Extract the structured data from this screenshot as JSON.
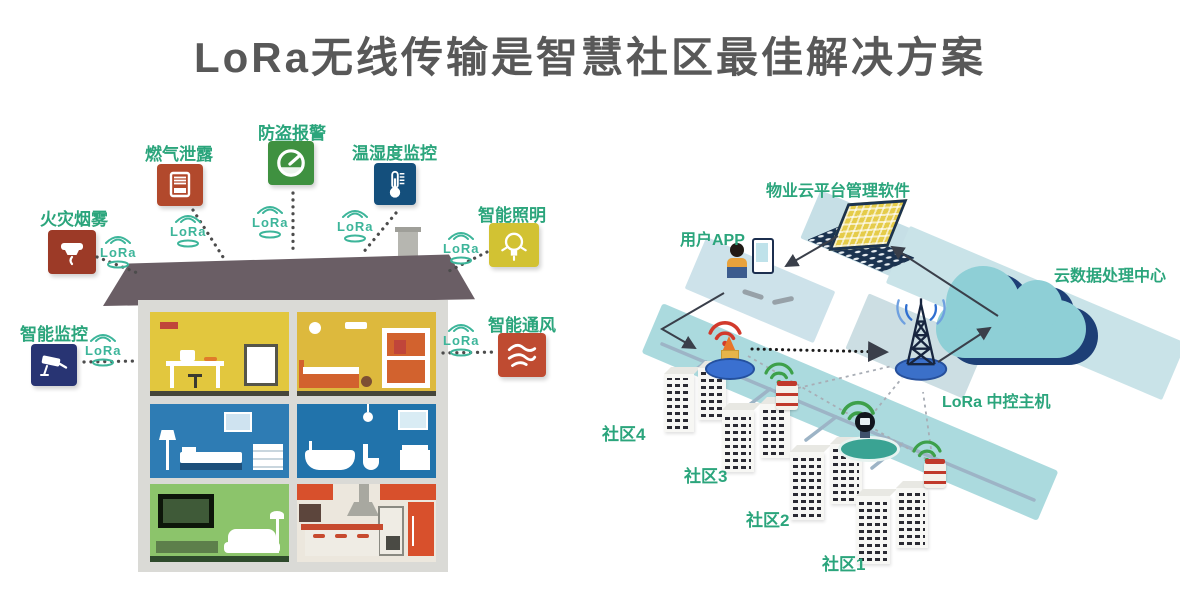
{
  "title": "LoRa无线传输是智慧社区最佳解决方案",
  "lora_badge": "LoRa",
  "sensors": [
    {
      "id": "fire-smoke",
      "label": "火灾烟雾",
      "color": "#9c3a27"
    },
    {
      "id": "gas-leak",
      "label": "燃气泄露",
      "color": "#b2492c"
    },
    {
      "id": "burglar-alarm",
      "label": "防盗报警",
      "color": "#3f9140"
    },
    {
      "id": "temp-humidity",
      "label": "温湿度监控",
      "color": "#144f7c"
    },
    {
      "id": "smart-lighting",
      "label": "智能照明",
      "color": "#d2c233"
    },
    {
      "id": "smart-monitoring",
      "label": "智能监控",
      "color": "#283473"
    },
    {
      "id": "smart-ventilation",
      "label": "智能通风",
      "color": "#bf4b31"
    }
  ],
  "network": {
    "property_software_label": "物业云平台管理软件",
    "user_app_label": "用户APP",
    "cloud_center_label": "云数据处理中心",
    "lora_host_label": "LoRa 中控主机",
    "communities": [
      "社区4",
      "社区3",
      "社区2",
      "社区1"
    ]
  },
  "colors": {
    "label_green": "#2ba57c",
    "badge_teal": "#3db59a",
    "title_gray": "#585858",
    "road_blue": "#abdade",
    "cloud_teal": "#8ecfd6",
    "cloud_navy": "#1d3f76"
  }
}
